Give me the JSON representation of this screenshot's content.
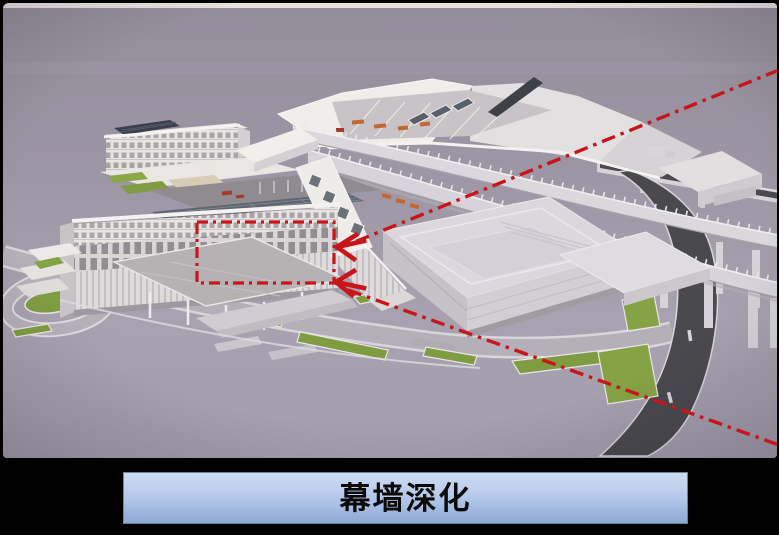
{
  "frame": {
    "background_color": "#000000",
    "top_highlight_color": "#eae6e2"
  },
  "scene": {
    "sky_top_color": "#948d9a",
    "sky_bottom_color": "#a8a2b0",
    "building_white": "#efede9",
    "building_shade": "#d6d3d9",
    "asphalt_color": "#4a494e",
    "landscape_green": "#7f9c40",
    "solar_panel_color": "#39404a",
    "accent_orange": "#c4662f"
  },
  "annotations": {
    "color": "#c9141a",
    "focus_rectangle": {
      "x": 197,
      "y": 222,
      "width": 137,
      "height": 61
    },
    "leader_line_upper": {
      "x1": 779,
      "y1": 70,
      "x2": 352,
      "y2": 243
    },
    "leader_line_lower": {
      "x1": 348,
      "y1": 290,
      "x2": 779,
      "y2": 445
    },
    "arrow_count": 2
  },
  "footer": {
    "title_label": "幕墙深化",
    "bar_gradient_top": "#cdd9f1",
    "bar_gradient_bottom": "#8ea9d4",
    "bar_border_color": "#6e7f9f",
    "text_color": "#0a0a0a"
  }
}
